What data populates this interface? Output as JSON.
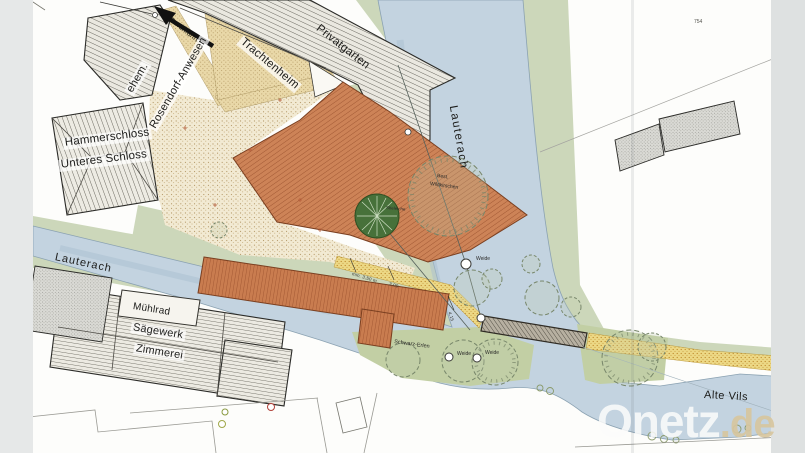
{
  "watermark": {
    "brand": "Onetz",
    "suffix": ".de"
  },
  "labels": {
    "privatgarten": "Privatgarten",
    "trachtenheim": "Trachtenheim",
    "ehem": "ehem.",
    "rosendorf_anwesen": "Rosendorf-Anwesen",
    "hammerschloss": "Hammerschloss",
    "unteres_schloss": "Unteres Schloss",
    "lauterach": "Lauterach",
    "muehlrad": "Mühlrad",
    "saegewerk": "Sägewerk",
    "zimmerei": "Zimmerei",
    "alte_vils": "Alte Vils",
    "durchfahrt": "Durchfahrt",
    "parcel_754": "754"
  },
  "vegetation": {
    "best": "Best.",
    "wildkirschen": "Wildkirschen",
    "stieleiche": "Stieleiche",
    "weide": "Weide",
    "schwarz_erlen": "Schwarz-Erlen"
  },
  "dimensions": {
    "d1": "min. 3,50 m",
    "d2": "3,00",
    "d3": "4,15"
  },
  "colors": {
    "water": "#c3d3e0",
    "bank": "#8ba2b2",
    "green": "#ccd7ba",
    "green_dark": "#c2cfa4",
    "roof_orange": "#ca7f55",
    "roof_hatch": "#9c5330",
    "courtyard": "#f2ead3",
    "path_yellow": "#ecd885",
    "road_tan": "#e9d8a8",
    "building_gray": "#e9e7df",
    "outline": "#2b2b28",
    "watermark_de": "#d8c69e",
    "scan_strip": "#e6e8e8"
  }
}
